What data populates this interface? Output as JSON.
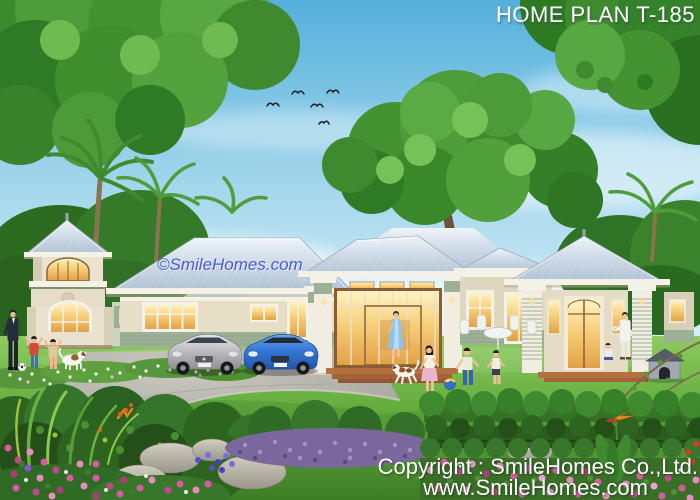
{
  "title": {
    "text": "HOME PLAN T-185"
  },
  "watermark": {
    "text": "©SmileHomes.com"
  },
  "footer": {
    "line1": "Copyright : SmileHomes Co.,Ltd.",
    "line2": "www.SmileHomes.com"
  },
  "colors": {
    "text_white": "#ffffff",
    "watermark_blue": "#4a5cd4",
    "sky_top": "#54b0dc",
    "sky_horizon": "#eaf5fa",
    "roof_light": "#dce6ef",
    "roof_shadow": "#b2c3d4",
    "wall_cream": "#eae2ce",
    "wall_sage": "#9caf97",
    "trim_white": "#f4f1e6",
    "window_warm": "#f2b95c",
    "lawn_green": "#63ab3d",
    "driveway_gray": "#ababa2",
    "hedge_dark": "#2d6520",
    "lavender": "#7a689c",
    "flower_pink": "#d65ba0",
    "flower_purple": "#7a5bc8",
    "terrace_brick": "#b4713f",
    "car_silver": "#b9b9bf",
    "car_blue": "#3578d8",
    "foliage_green": "#3f8a2e"
  }
}
